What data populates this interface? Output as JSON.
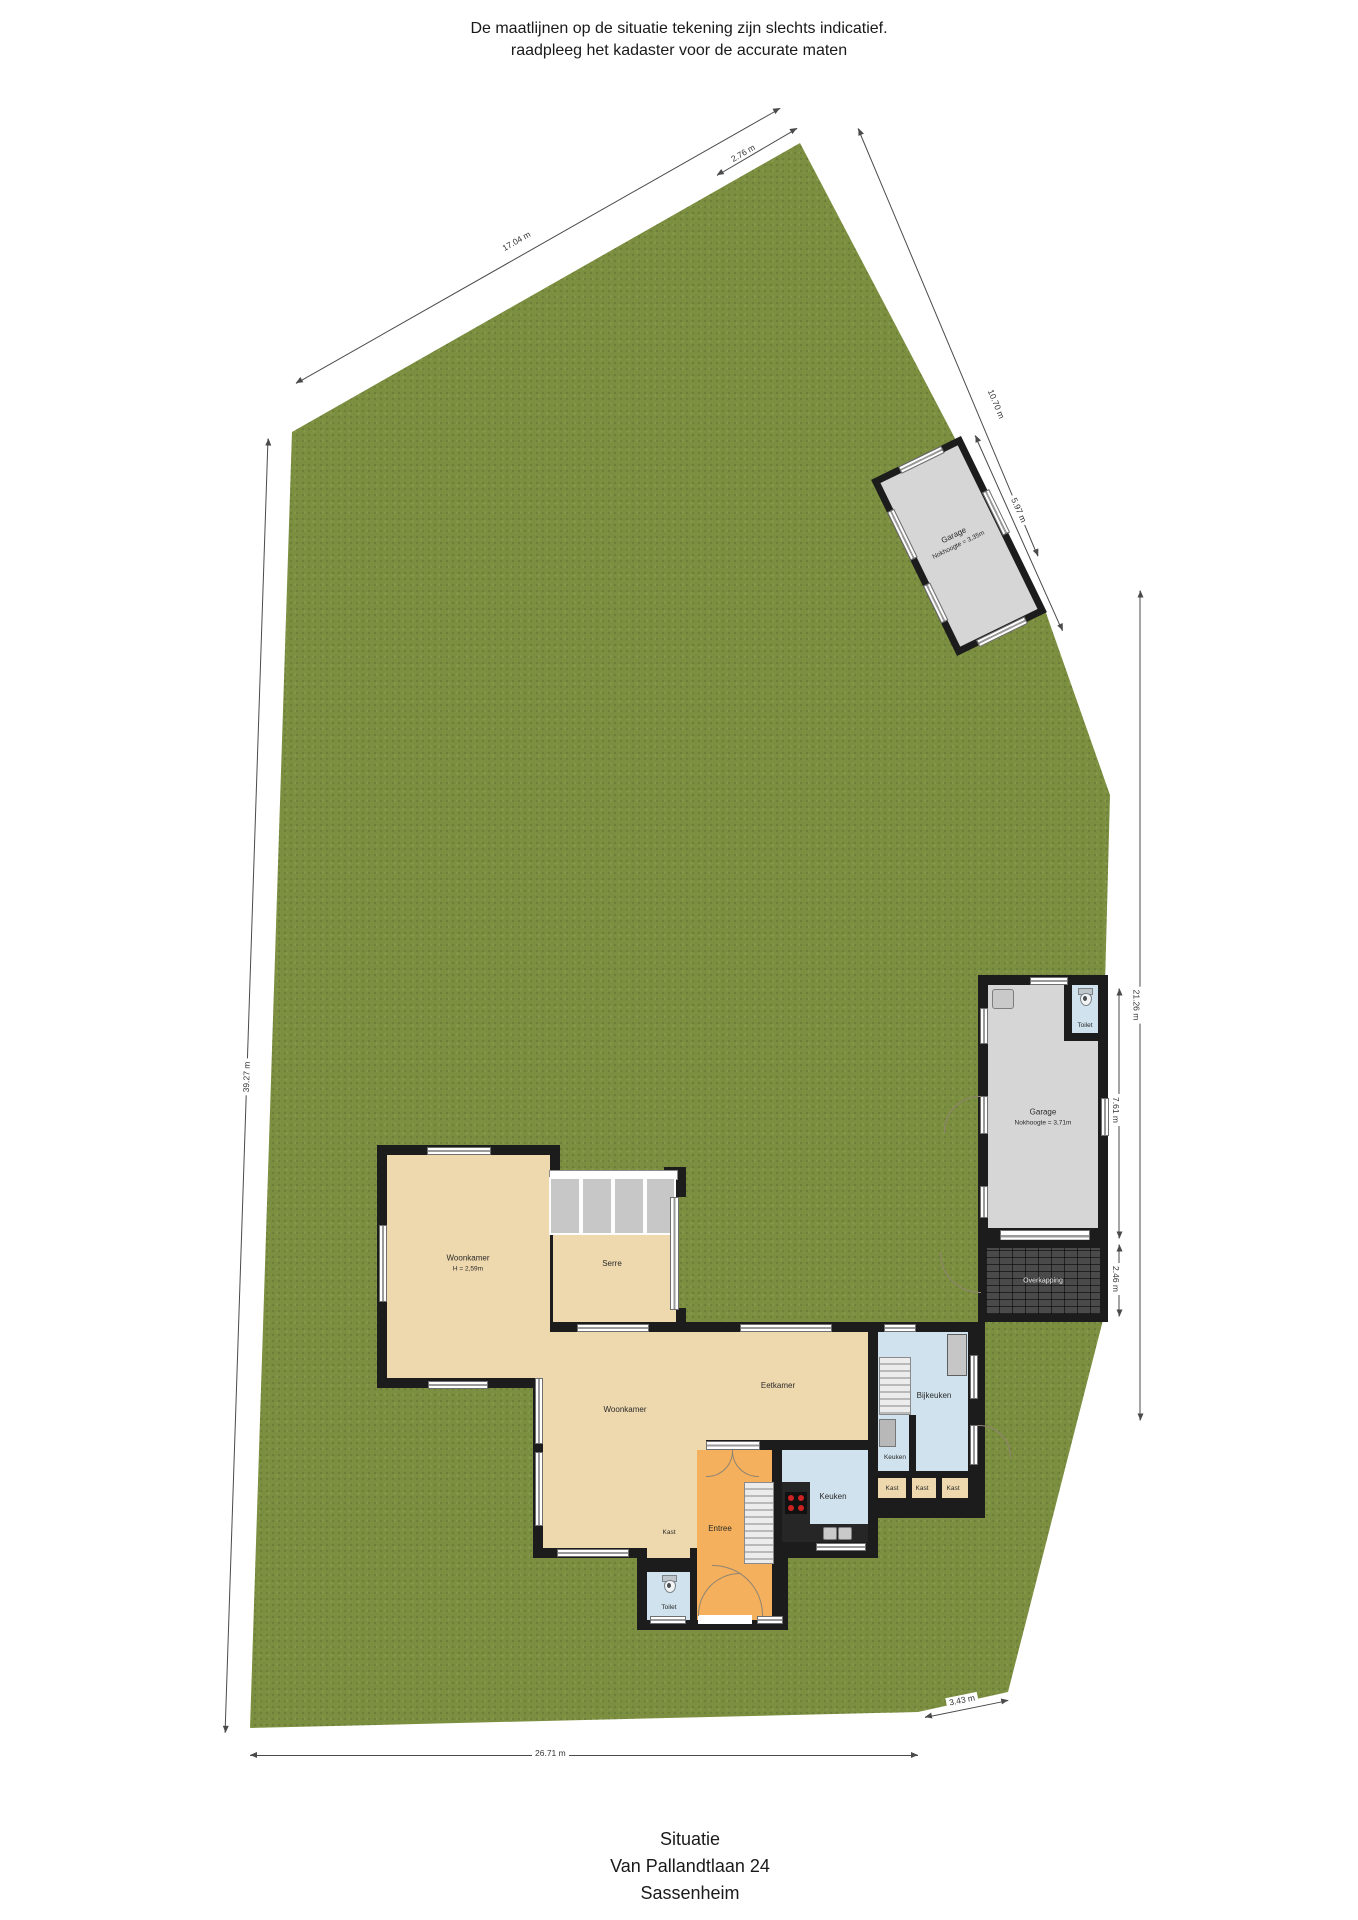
{
  "disclaimer": {
    "line1": "De maatlijnen op de situatie tekening zijn slechts indicatief.",
    "line2": "raadpleeg het kadaster voor de accurate maten"
  },
  "title": {
    "line1": "Situatie",
    "line2": "Van Pallandtlaan 24",
    "line3": "Sassenheim"
  },
  "rooms": {
    "woonkamer1": {
      "name": "Woonkamer",
      "height": "H = 2,59m"
    },
    "serre": {
      "name": "Serre"
    },
    "woonkamer2": {
      "name": "Woonkamer"
    },
    "eetkamer": {
      "name": "Eetkamer"
    },
    "keuken": {
      "name": "Keuken"
    },
    "keuken2": {
      "name": "Keuken"
    },
    "bijkeuken": {
      "name": "Bijkeuken"
    },
    "entree": {
      "name": "Entree"
    },
    "kast": {
      "name": "Kast"
    },
    "kast1": {
      "name": "Kast"
    },
    "kast2": {
      "name": "Kast"
    },
    "kast3": {
      "name": "Kast"
    },
    "toilet": {
      "name": "Toilet"
    },
    "toilet_garage": {
      "name": "Toilet"
    },
    "garage": {
      "name": "Garage",
      "nokhoogte": "Nokhoogte = 3,71m"
    },
    "garage_top": {
      "name": "Garage",
      "nokhoogte": "Nokhoogte = 3,35m"
    },
    "overkapping": {
      "name": "Overkapping"
    }
  },
  "dimensions": {
    "top_left": "17.04 m",
    "top_short": "2.76 m",
    "upper_right": "10.70 m",
    "garage_top_side": "5.97 m",
    "left": "39.27 m",
    "right": "21.26 m",
    "garage_right": "7.61 m",
    "overkapping": "2.46 m",
    "bottom": "26.71 m",
    "bottom_right": "3.43 m"
  },
  "colors": {
    "grass": "#7c8f41",
    "wall": "#1c1c1c",
    "floor_tan": "#eed8ad",
    "floor_blue": "#cfe2ed",
    "floor_orange": "#f4b05c",
    "garage_gray": "#d6d6d6",
    "burner_red": "#cc2222"
  }
}
